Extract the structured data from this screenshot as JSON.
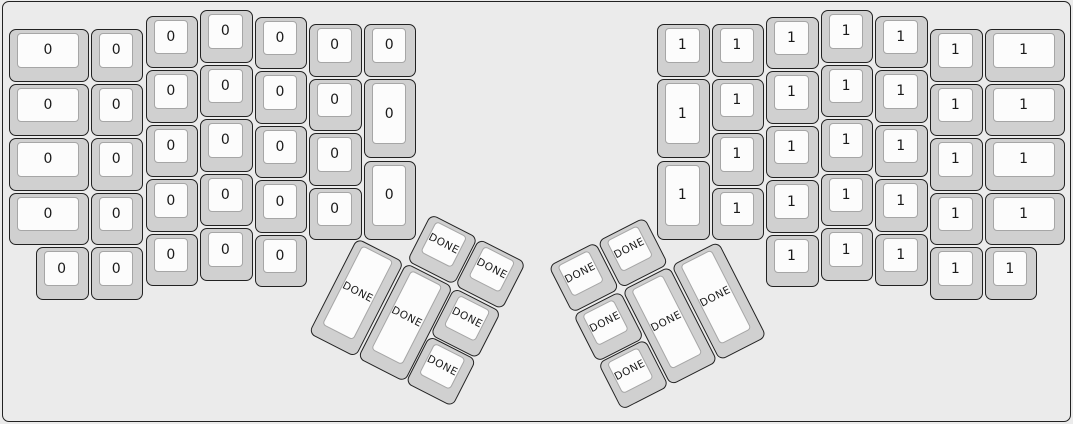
{
  "canvas": {
    "width": 1073,
    "height": 424,
    "background_color": "#ebebeb",
    "frame_outline_color": "#262626"
  },
  "key_style": {
    "side_color": "#d0d0d0",
    "top_color": "#fcfcfc",
    "outline_color": "#222222",
    "top_border_color": "#a6a6a6",
    "label_color": "#1a1a1a"
  },
  "legend": {
    "left_half_label": "0",
    "right_half_label": "1",
    "thumb_cluster_label": "DONE"
  },
  "keys": [
    {
      "x": 9,
      "y": 29,
      "w": 80,
      "label": "0"
    },
    {
      "x": 9,
      "y": 83.6,
      "w": 80,
      "label": "0"
    },
    {
      "x": 9,
      "y": 138.2,
      "w": 80,
      "label": "0"
    },
    {
      "x": 9,
      "y": 192.8,
      "w": 80,
      "label": "0"
    },
    {
      "x": 90.9,
      "y": 29,
      "label": "0"
    },
    {
      "x": 90.9,
      "y": 83.6,
      "label": "0"
    },
    {
      "x": 90.9,
      "y": 138.2,
      "label": "0"
    },
    {
      "x": 90.9,
      "y": 192.8,
      "label": "0"
    },
    {
      "x": 36.3,
      "y": 247.4,
      "label": "0"
    },
    {
      "x": 90.9,
      "y": 247.4,
      "label": "0"
    },
    {
      "x": 145.5,
      "y": 15.5,
      "label": "0"
    },
    {
      "x": 145.5,
      "y": 70.1,
      "label": "0"
    },
    {
      "x": 145.5,
      "y": 124.7,
      "label": "0"
    },
    {
      "x": 145.5,
      "y": 179.3,
      "label": "0"
    },
    {
      "x": 145.5,
      "y": 233.9,
      "label": "0"
    },
    {
      "x": 200.1,
      "y": 10,
      "label": "0"
    },
    {
      "x": 200.1,
      "y": 64.6,
      "label": "0"
    },
    {
      "x": 200.1,
      "y": 119.2,
      "label": "0"
    },
    {
      "x": 200.1,
      "y": 173.8,
      "label": "0"
    },
    {
      "x": 200.1,
      "y": 228.4,
      "label": "0"
    },
    {
      "x": 254.7,
      "y": 16.5,
      "label": "0"
    },
    {
      "x": 254.7,
      "y": 71.1,
      "label": "0"
    },
    {
      "x": 254.7,
      "y": 125.7,
      "label": "0"
    },
    {
      "x": 254.7,
      "y": 180.3,
      "label": "0"
    },
    {
      "x": 254.7,
      "y": 234.9,
      "label": "0"
    },
    {
      "x": 309.3,
      "y": 24,
      "label": "0"
    },
    {
      "x": 309.3,
      "y": 78.6,
      "label": "0"
    },
    {
      "x": 309.3,
      "y": 133.2,
      "label": "0"
    },
    {
      "x": 309.3,
      "y": 187.8,
      "label": "0"
    },
    {
      "x": 363.9,
      "y": 24,
      "label": "0"
    },
    {
      "x": 363.9,
      "y": 78.6,
      "h": 79.9,
      "label": "0"
    },
    {
      "x": 363.9,
      "y": 160.5,
      "h": 79.9,
      "label": "0"
    },
    {
      "x": 411.6,
      "y": 182.9,
      "r": 27,
      "tox": -54.6,
      "toy": 54.6,
      "label": "DONE"
    },
    {
      "x": 466.2,
      "y": 182.9,
      "r": 27,
      "tox": -109.2,
      "toy": 54.6,
      "label": "DONE"
    },
    {
      "x": 357,
      "y": 237.5,
      "h": 107.2,
      "r": 27,
      "tox": 0,
      "toy": 0,
      "label": "DONE"
    },
    {
      "x": 411.6,
      "y": 237.5,
      "h": 107.2,
      "r": 27,
      "tox": -54.6,
      "toy": 0,
      "label": "DONE"
    },
    {
      "x": 466.2,
      "y": 237.5,
      "r": 27,
      "tox": -109.2,
      "toy": 0,
      "label": "DONE"
    },
    {
      "x": 466.2,
      "y": 292.1,
      "r": 27,
      "tox": -109.2,
      "toy": -54.6,
      "label": "DONE"
    },
    {
      "x": 657,
      "y": 24,
      "label": "1"
    },
    {
      "x": 657,
      "y": 78.6,
      "h": 79.9,
      "label": "1"
    },
    {
      "x": 657,
      "y": 160.5,
      "h": 79.9,
      "label": "1"
    },
    {
      "x": 711.6,
      "y": 24,
      "label": "1"
    },
    {
      "x": 711.6,
      "y": 78.6,
      "label": "1"
    },
    {
      "x": 711.6,
      "y": 133.2,
      "label": "1"
    },
    {
      "x": 711.6,
      "y": 187.8,
      "label": "1"
    },
    {
      "x": 766.2,
      "y": 16.5,
      "label": "1"
    },
    {
      "x": 766.2,
      "y": 71.1,
      "label": "1"
    },
    {
      "x": 766.2,
      "y": 125.7,
      "label": "1"
    },
    {
      "x": 766.2,
      "y": 180.3,
      "label": "1"
    },
    {
      "x": 766.2,
      "y": 234.9,
      "label": "1"
    },
    {
      "x": 820.8,
      "y": 10,
      "label": "1"
    },
    {
      "x": 820.8,
      "y": 64.6,
      "label": "1"
    },
    {
      "x": 820.8,
      "y": 119.2,
      "label": "1"
    },
    {
      "x": 820.8,
      "y": 173.8,
      "label": "1"
    },
    {
      "x": 820.8,
      "y": 228.4,
      "label": "1"
    },
    {
      "x": 875.4,
      "y": 15.5,
      "label": "1"
    },
    {
      "x": 875.4,
      "y": 70.1,
      "label": "1"
    },
    {
      "x": 875.4,
      "y": 124.7,
      "label": "1"
    },
    {
      "x": 875.4,
      "y": 179.3,
      "label": "1"
    },
    {
      "x": 875.4,
      "y": 233.9,
      "label": "1"
    },
    {
      "x": 930,
      "y": 29,
      "label": "1"
    },
    {
      "x": 930,
      "y": 83.6,
      "label": "1"
    },
    {
      "x": 930,
      "y": 138.2,
      "label": "1"
    },
    {
      "x": 930,
      "y": 192.8,
      "label": "1"
    },
    {
      "x": 930,
      "y": 247.4,
      "label": "1"
    },
    {
      "x": 984.6,
      "y": 29,
      "w": 80,
      "label": "1"
    },
    {
      "x": 984.6,
      "y": 83.6,
      "w": 80,
      "label": "1"
    },
    {
      "x": 984.6,
      "y": 138.2,
      "w": 80,
      "label": "1"
    },
    {
      "x": 984.6,
      "y": 192.8,
      "w": 80,
      "label": "1"
    },
    {
      "x": 984.6,
      "y": 247.4,
      "label": "1"
    },
    {
      "x": 573.3,
      "y": 260.2,
      "r": -27,
      "tox": 0,
      "toy": 54.6,
      "label": "DONE"
    },
    {
      "x": 627.9,
      "y": 260.2,
      "r": -27,
      "tox": -54.6,
      "toy": 54.6,
      "label": "DONE"
    },
    {
      "x": 573.3,
      "y": 314.8,
      "r": -27,
      "tox": 0,
      "toy": 0,
      "label": "DONE"
    },
    {
      "x": 627.9,
      "y": 314.8,
      "h": 107.2,
      "r": -27,
      "tox": -54.6,
      "toy": 0,
      "label": "DONE"
    },
    {
      "x": 682.5,
      "y": 314.8,
      "h": 107.2,
      "r": -27,
      "tox": -109.2,
      "toy": 0,
      "label": "DONE"
    },
    {
      "x": 573.3,
      "y": 369.4,
      "r": -27,
      "tox": 0,
      "toy": -54.6,
      "label": "DONE"
    }
  ]
}
